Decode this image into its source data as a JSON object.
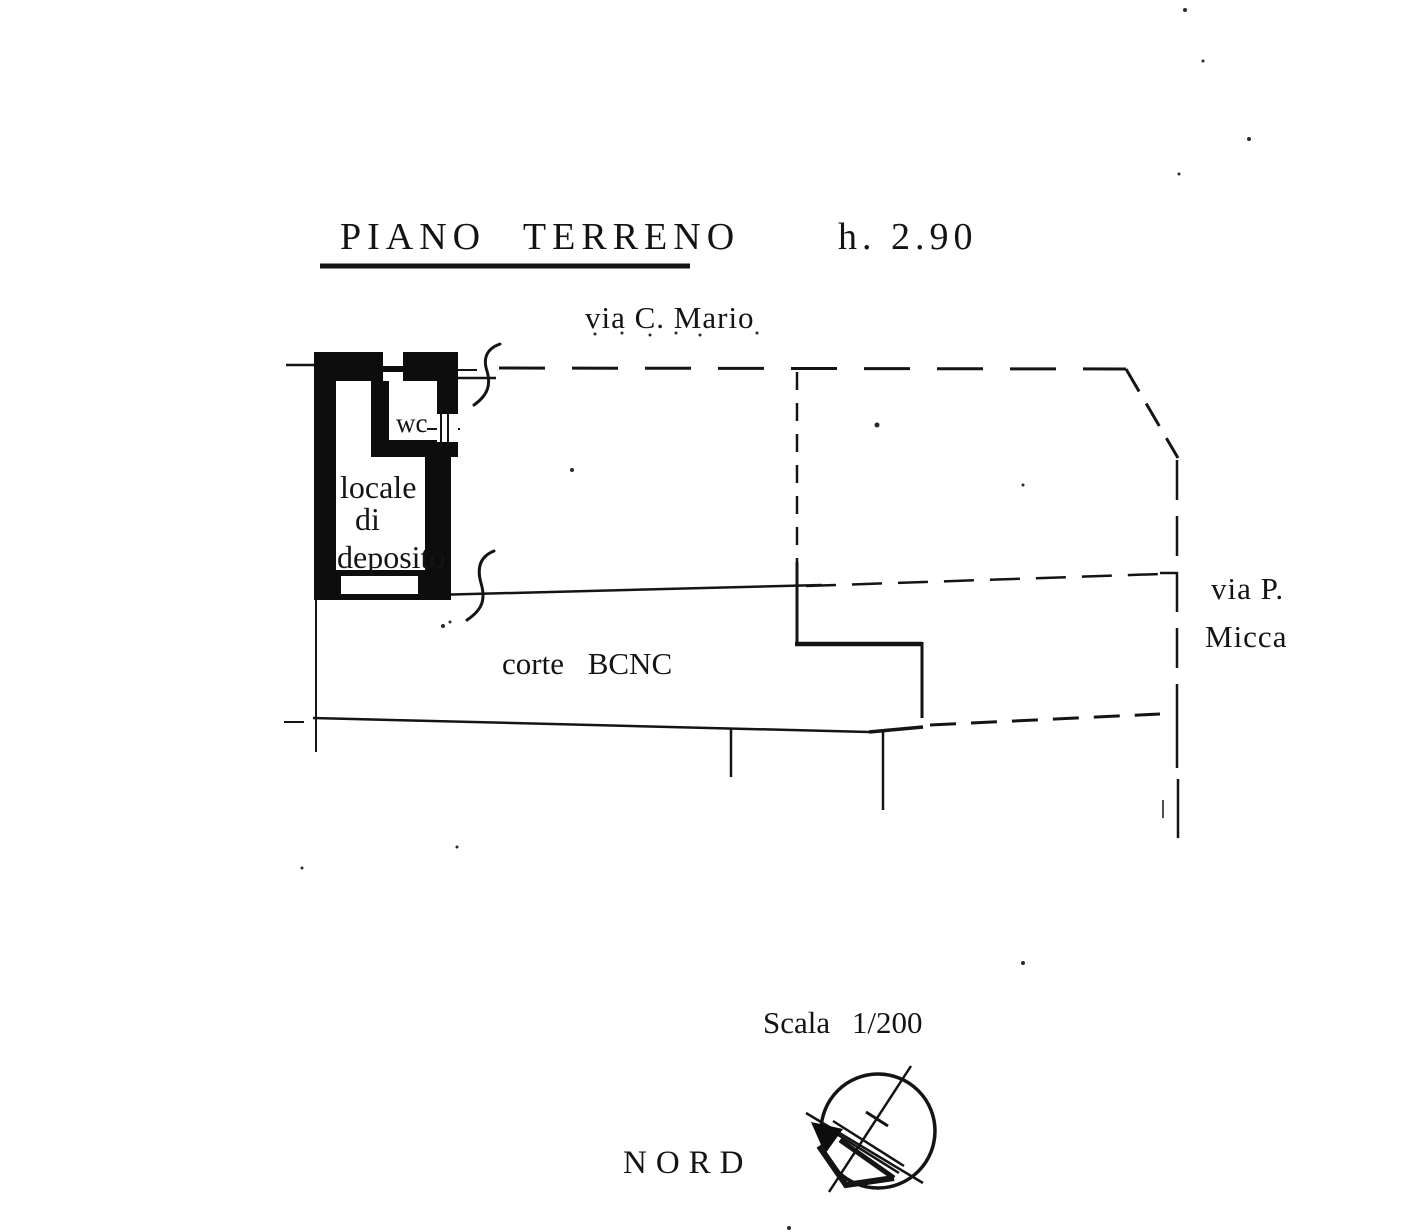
{
  "document": {
    "kind": "scanned cadastral floor plan",
    "colors": {
      "paper": "#ffffff",
      "ink": "#141414"
    }
  },
  "header": {
    "plan_title": "PIANO TERRENO",
    "height_note": "h. 2.90"
  },
  "streets": {
    "top": "via C. Mario",
    "right_line1": "via P.",
    "right_line2": "Micca"
  },
  "rooms": {
    "wc": "wc",
    "storage_line1": "locale",
    "storage_line2": "di",
    "storage_line3": "deposito",
    "courtyard": "corte BCNC"
  },
  "footer": {
    "scale": "Scala 1/200",
    "north": "NORD"
  }
}
